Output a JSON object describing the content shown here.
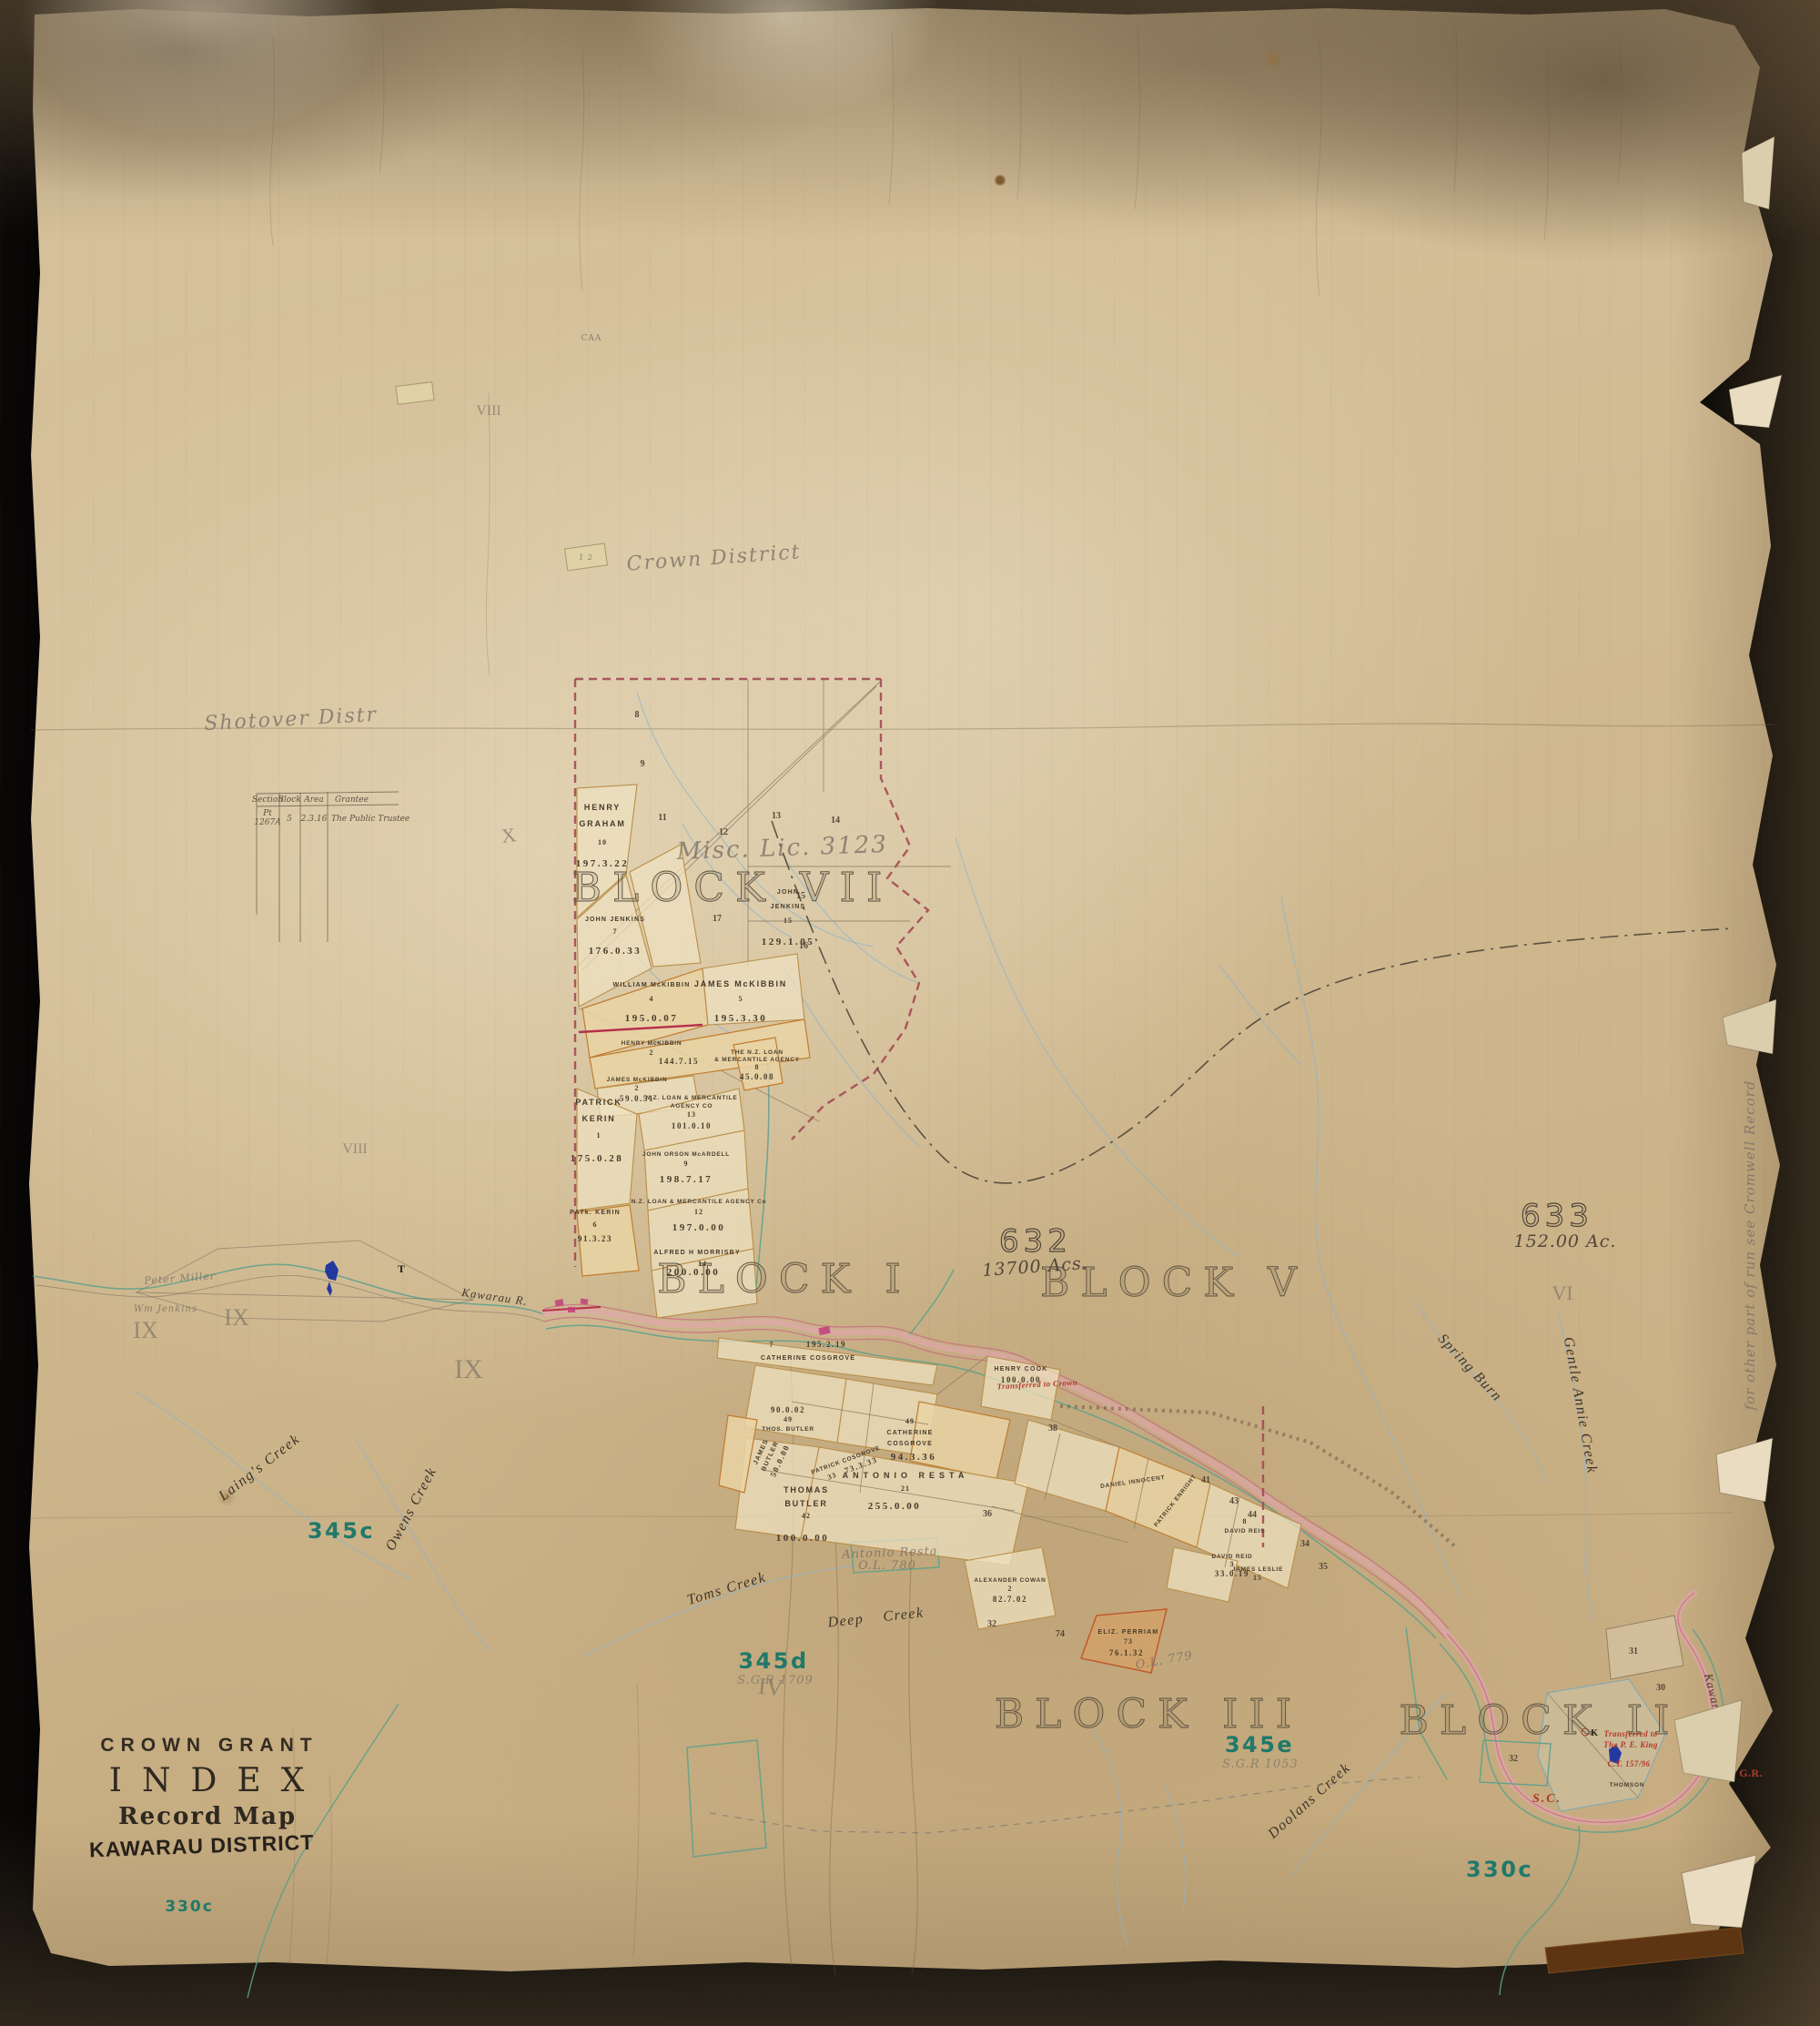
{
  "title_block": {
    "line1": "CROWN GRANT",
    "line2": "INDEX",
    "line3": "Record Map",
    "line4": "KAWARAU DISTRICT"
  },
  "index_table": {
    "headers": [
      "Section",
      "Block",
      "Area",
      "Grantee"
    ],
    "row": {
      "section_top": "Pt",
      "section": "1267A",
      "block": "5",
      "area": "2.3.16",
      "grantee": "The Public Trustee"
    }
  },
  "block_titles": {
    "vii": "BLOCK VII",
    "i": "BLOCK I",
    "v": "BLOCK V",
    "iii": "BLOCK III",
    "ii": "BLOCK II"
  },
  "runs": {
    "n632": "632",
    "a632": "13700 Acs.",
    "n633": "633",
    "a633": "152.00 Ac."
  },
  "leases": {
    "c345": "345c",
    "d345": "345d",
    "e345": "345e",
    "c330_right": "330c",
    "c330_left": "330c",
    "sgr_345e": "S.G.R 1053",
    "sgr_345d": "S.G.R 1709"
  },
  "creeks": {
    "laings": "Laing's Creek",
    "owens": "Owens Creek",
    "toms": "Toms Creek",
    "deep": "Deep Creek",
    "spring": "Spring Burn",
    "gentle_annie": "Gentle Annie Creek",
    "doolans": "Doolans Creek",
    "kawarau_left": "Kawarau R.",
    "kawarau_right": "Kawarau River"
  },
  "pencil_notes": {
    "misc_lic": "Misc. Lic. 3123",
    "crown_district": "Crown District",
    "shotover": "Shotover Distr",
    "ol779": "O.L. 779",
    "antonio_resta": "Antonio Resta",
    "ol780": "O.L. 780",
    "peter_miller": "Peter Miller",
    "wm_jenkins": "Wm Jenkins",
    "cromwell_note": "for other part of run see Cromwell Record",
    "caa": "CAA",
    "t_mark": "T",
    "k_mark": "K",
    "sticker": "1 2"
  },
  "romans": [
    "X",
    "VIII",
    "VIII",
    "IX",
    "IX",
    "IX",
    "IV",
    "VI"
  ],
  "red_notes": {
    "transfer_crown": "Transferred to Crown",
    "transfer_1": "Transferred to",
    "transfer_2": "The P. E. King",
    "transfer_3": "C.T. 157/96",
    "thomson": "THOMSON",
    "gr33": "33 G.R.",
    "sc": "S.C."
  },
  "parcels": [
    {
      "n1": "HENRY",
      "n2": "GRAHAM",
      "sec": "10",
      "area": "197.3.22"
    },
    {
      "n1": "JOHN JENKINS",
      "n2": "",
      "sec": "7",
      "area": "176.0.33"
    },
    {
      "n1": "JOHN",
      "n2": "JENKINS",
      "sec": "15",
      "area": "129.1.05"
    },
    {
      "n1": "WILLIAM McKIBBIN",
      "n2": "",
      "sec": "4",
      "area": "195.0.07"
    },
    {
      "n1": "JAMES McKIBBIN",
      "n2": "",
      "sec": "5",
      "area": "195.3.30"
    },
    {
      "n1": "HENRY McKIBBIN",
      "n2": "",
      "sec": "2",
      "area": "144.7.15"
    },
    {
      "n1": "JAMES McKIBBIN",
      "n2": "",
      "sec": "2",
      "area": "59.0.51"
    },
    {
      "n1": "PATRICK",
      "n2": "KERIN",
      "sec": "1",
      "area": "175.0.28"
    },
    {
      "n1": "PATk. KERIN",
      "n2": "",
      "sec": "6",
      "area": "91.3.23"
    },
    {
      "n1": "N.Z. LOAN & MERCANTILE",
      "n2": "AGENCY CO",
      "sec": "13",
      "area": "101.0.10"
    },
    {
      "n1": "JOHN ORSON McARDELL",
      "n2": "",
      "sec": "9",
      "area": "198.7.17"
    },
    {
      "n1": "N.Z. LOAN & MERCANTILE AGENCY Co",
      "n2": "",
      "sec": "12",
      "area": "197.0.00"
    },
    {
      "n1": "ALFRED H MORRISBY",
      "n2": "",
      "sec": "14",
      "area": "200.0.00"
    },
    {
      "n1": "THE N.Z. LOAN",
      "n2": "& MERCANTILE AGENCY",
      "sec": "8",
      "area": "45.0.08"
    },
    {
      "n1": "CATHERINE COSGROVE",
      "n2": "",
      "sec": "7",
      "area": "195.2.19"
    },
    {
      "n1": "HENRY COOK",
      "n2": "",
      "sec": "",
      "area": "100.0.00"
    },
    {
      "n1": "CATHERINE",
      "n2": "COSGROVE",
      "sec": "49",
      "area": "94.3.36"
    },
    {
      "n1": "ANTONIO RESTA",
      "n2": "",
      "sec": "21",
      "area": "255.0.00"
    },
    {
      "n1": "THOMAS",
      "n2": "BUTLER",
      "sec": "42",
      "area": "100.0.00"
    },
    {
      "n1": "JAMES",
      "n2": "BUTLER",
      "sec": "",
      "area": "50.0.00"
    },
    {
      "n1": "PATRICK COSGROVE",
      "n2": "",
      "sec": "33",
      "area": "73.3.33"
    },
    {
      "n1": "ELIZ. PERRIAM",
      "n2": "",
      "sec": "73",
      "area": "76.1.32"
    },
    {
      "n1": "DAVID REID",
      "n2": "",
      "sec": "3",
      "area": "33.0.19"
    },
    {
      "n1": "ALEXANDER COWAN",
      "n2": "",
      "sec": "2",
      "area": "82.7.02"
    },
    {
      "n1": "DANIEL INNOCENT",
      "n2": "",
      "sec": "",
      "area": ""
    },
    {
      "n1": "PATRICK ENRIGHT",
      "n2": "",
      "sec": "",
      "area": ""
    },
    {
      "n1": "DAVID REIS",
      "n2": "",
      "sec": "8",
      "area": ""
    },
    {
      "n1": "JAMES LESLIE",
      "n2": "",
      "sec": "15",
      "area": ""
    },
    {
      "n1": "THOS. BUTLER",
      "n2": "",
      "sec": "49",
      "area": "90.0.02"
    }
  ],
  "sections": [
    "8",
    "9",
    "11",
    "12",
    "13",
    "14",
    "15",
    "16",
    "17",
    "38",
    "41",
    "43",
    "44",
    "34",
    "35",
    "74",
    "32",
    "30",
    "31",
    "36"
  ],
  "colors": {
    "paper": "#d2bd97",
    "ink": "#3f382c",
    "lease_green": "#20796a",
    "note_red": "#b23a2c",
    "river_pink": "#e5a4b4",
    "water_blue": "#8fb3c9",
    "boundary_teal": "#5ba08c",
    "parcel_tan": "#c8964e"
  }
}
